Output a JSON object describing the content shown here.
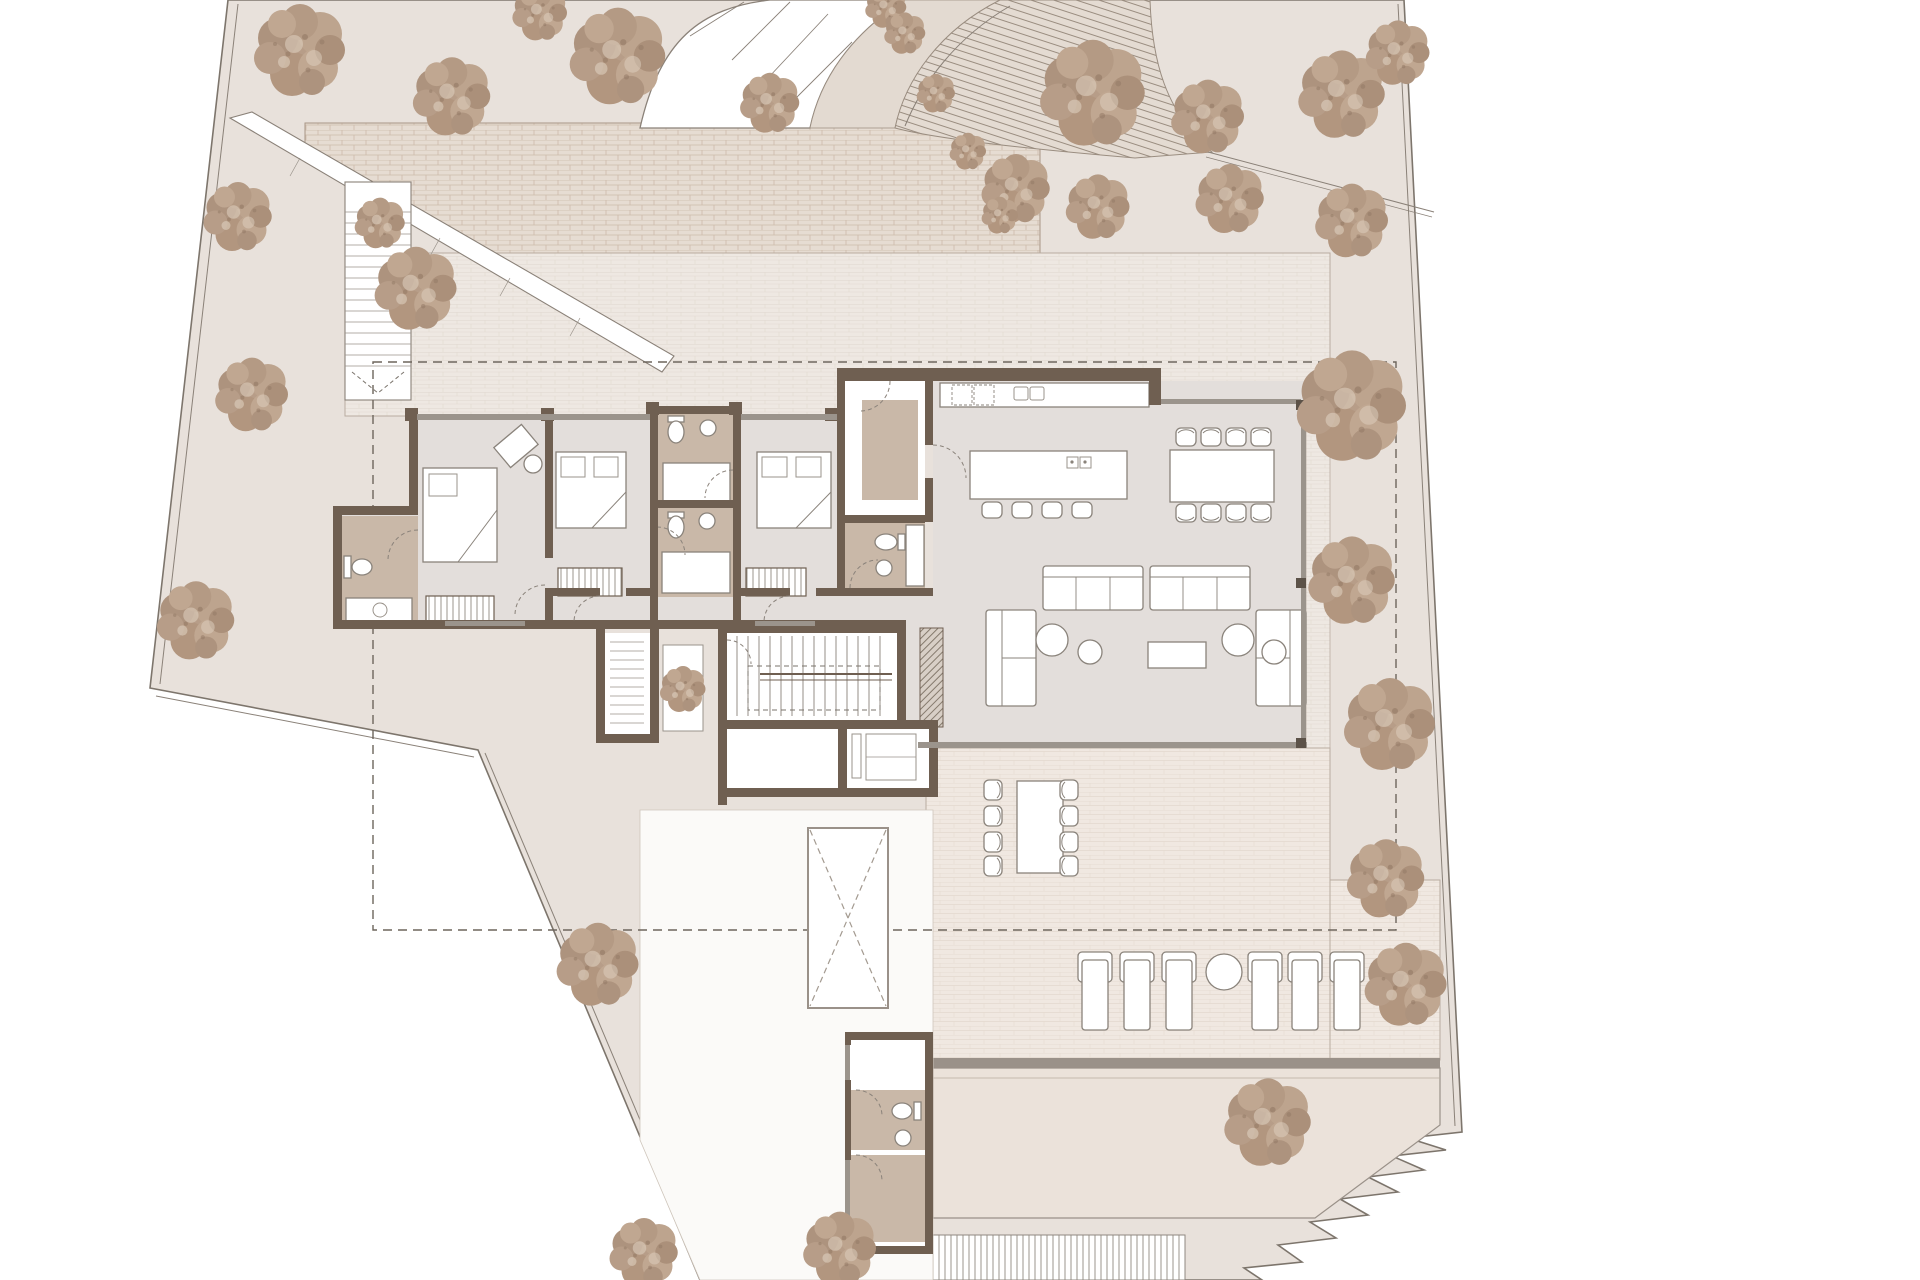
{
  "meta": {
    "kind": "architectural-site-plan",
    "description": "Ground floor plan of a villa: 3 bedrooms with bathrooms, entry vestibule, open kitchen-dining-living room, interior stair, terraces, pool deck, garden with trees, curved driveway",
    "visible_text": []
  },
  "colors": {
    "background": "#ffffff",
    "parcel": "#e8e1db",
    "boundary": "#7d756c",
    "tree_base": "#b79d88",
    "tree_dark": "#a8917c",
    "tree_light": "#c6ae99",
    "brick_court": "#e6dcd2",
    "brick_joint": "#c9b7a5",
    "terrace_tile": "#eee8e2",
    "terrace_joint": "#dbd1c8",
    "wall_brown": "#6f5f51",
    "glass_gray": "#9b948c",
    "interior_floor": "#e3dedb",
    "bath_tan": "#c9b8a8",
    "overhang_dash": "#6d655c",
    "pool_deck": "#ebe2da"
  },
  "site": {
    "trees": [
      [
        300,
        52,
        1.0
      ],
      [
        452,
        98,
        0.85
      ],
      [
        618,
        58,
        1.05
      ],
      [
        540,
        14,
        0.6
      ],
      [
        770,
        104,
        0.65
      ],
      [
        1093,
        95,
        1.15
      ],
      [
        1208,
        118,
        0.8
      ],
      [
        1342,
        96,
        0.95
      ],
      [
        1398,
        54,
        0.7
      ],
      [
        1016,
        190,
        0.75
      ],
      [
        1098,
        208,
        0.7
      ],
      [
        1230,
        200,
        0.75
      ],
      [
        1352,
        222,
        0.8
      ],
      [
        238,
        218,
        0.75
      ],
      [
        380,
        224,
        0.55
      ],
      [
        252,
        396,
        0.8
      ],
      [
        196,
        622,
        0.85
      ],
      [
        416,
        290,
        0.9
      ],
      [
        1352,
        408,
        1.2
      ],
      [
        1352,
        582,
        0.95
      ],
      [
        1390,
        726,
        1.0
      ],
      [
        1386,
        880,
        0.85
      ],
      [
        1406,
        986,
        0.9
      ],
      [
        1268,
        1124,
        0.95
      ],
      [
        598,
        966,
        0.9
      ],
      [
        644,
        1254,
        0.75
      ],
      [
        840,
        1250,
        0.8
      ]
    ],
    "driveway_shrubs": [
      [
        886,
        8,
        0.45
      ],
      [
        905,
        34,
        0.45
      ],
      [
        936,
        94,
        0.42
      ],
      [
        968,
        152,
        0.4
      ],
      [
        1000,
        216,
        0.4
      ]
    ],
    "planter_shrub": [
      683,
      690,
      0.5
    ]
  },
  "house": {
    "bedrooms": 3,
    "bathrooms": 4,
    "has_entry_mat": true,
    "has_fireplace_hatch": true,
    "light_shaft_x_marked": true
  },
  "furniture": {
    "island_stools": {
      "y": 501,
      "xs": [
        982,
        1012,
        1042,
        1072
      ]
    },
    "dining_chairs": {
      "top_y": 428,
      "bottom_y": 504,
      "xs": [
        1176,
        1201,
        1226,
        1251
      ]
    },
    "outdoor_chairs": {
      "left_x": 993,
      "right_x": 1069,
      "ys": [
        790,
        816,
        842,
        866
      ]
    },
    "sun_loungers": {
      "y": 952,
      "w": 34,
      "h": 78,
      "xs": [
        1078,
        1120,
        1162,
        1248,
        1288,
        1330
      ]
    },
    "lounger_table": {
      "cx": 1224,
      "cy": 972,
      "r": 18
    },
    "sofas": 2,
    "chaises": 2,
    "poufs": 4,
    "beds": 3
  }
}
